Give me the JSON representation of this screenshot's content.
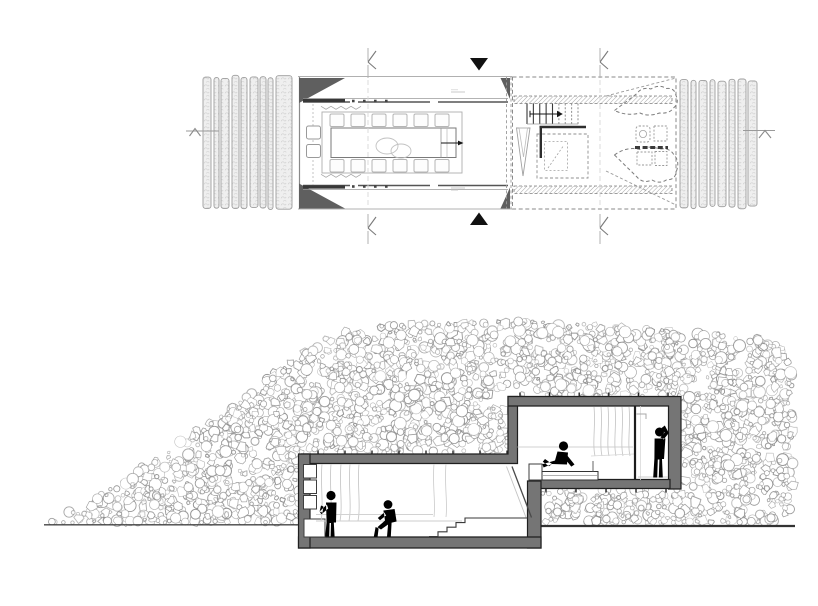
{
  "canvas": {
    "width": 818,
    "height": 606,
    "background": "#ffffff"
  },
  "palette": {
    "wall_fill": "#757575",
    "wall_stroke": "#1f1f1f",
    "triangle_fill": "#5f5f5f",
    "hatch_fill": "#efefef",
    "hatch_stroke": "#9c9c9c",
    "pebble_stroke": "#8d8d8d",
    "figure_fill": "#000000",
    "line_dark": "#2e2e2e",
    "line_mid": "#8a8a8a",
    "line_light": "#c9c9c9"
  },
  "plan": {
    "left_hatch": {
      "y_top": 75,
      "y_bottom": 210,
      "strips": [
        [
          203,
          8
        ],
        [
          214,
          5
        ],
        [
          221,
          8
        ],
        [
          232,
          7
        ],
        [
          241,
          6
        ],
        [
          250,
          8
        ],
        [
          260,
          6
        ],
        [
          268,
          5
        ],
        [
          276,
          16
        ]
      ]
    },
    "right_hatch": {
      "y_top": 78,
      "y_bottom": 209,
      "strips": [
        [
          680,
          8
        ],
        [
          691,
          5
        ],
        [
          699,
          8
        ],
        [
          710,
          5
        ],
        [
          718,
          8
        ],
        [
          729,
          6
        ],
        [
          738,
          8
        ],
        [
          748,
          9
        ]
      ]
    },
    "dining": {
      "chair_xs": [
        330,
        351,
        372,
        393,
        414,
        435
      ],
      "stool_ys": [
        126,
        144.5
      ]
    },
    "stair": {
      "risers": 9,
      "solid_risers": 5
    },
    "k_markers": [
      [
        368,
        48
      ],
      [
        600,
        48
      ],
      [
        368,
        214
      ],
      [
        600,
        214
      ]
    ],
    "flag_down": [
      479,
      58
    ],
    "flag_up": [
      479,
      225
    ],
    "side_marker_left": [
      186,
      131
    ],
    "side_marker_right": [
      743,
      130.5
    ]
  },
  "section": {
    "mound_profile": [
      [
        48,
        524
      ],
      [
        70,
        510
      ],
      [
        95,
        497
      ],
      [
        115,
        486
      ],
      [
        135,
        471
      ],
      [
        155,
        457
      ],
      [
        175,
        445
      ],
      [
        200,
        429
      ],
      [
        225,
        411
      ],
      [
        250,
        394
      ],
      [
        275,
        372
      ],
      [
        295,
        356
      ],
      [
        315,
        344
      ],
      [
        335,
        334
      ],
      [
        355,
        329
      ],
      [
        380,
        326
      ],
      [
        410,
        324
      ],
      [
        440,
        323
      ],
      [
        470,
        322
      ],
      [
        500,
        321
      ],
      [
        530,
        321
      ],
      [
        560,
        322
      ],
      [
        590,
        324
      ],
      [
        620,
        326
      ],
      [
        650,
        329
      ],
      [
        680,
        331
      ],
      [
        710,
        333
      ],
      [
        740,
        335
      ],
      [
        765,
        338
      ],
      [
        780,
        342
      ],
      [
        788,
        355
      ],
      [
        792,
        375
      ],
      [
        794,
        400
      ],
      [
        795,
        440
      ],
      [
        794,
        480
      ],
      [
        793,
        524
      ]
    ],
    "building_envelope": [
      [
        299,
        454
      ],
      [
        509,
        454
      ],
      [
        509,
        397
      ],
      [
        681,
        397
      ],
      [
        681,
        489
      ],
      [
        541,
        489
      ],
      [
        541,
        527
      ],
      [
        299,
        527
      ]
    ],
    "pebbles": {
      "seed": 1337,
      "attempts": 5200,
      "r_min": 1.7,
      "r_max": 6.0
    },
    "ground_left": [
      44,
      301,
      524.8
    ],
    "ground_right": [
      538,
      795,
      526
    ],
    "figures": [
      {
        "pose": "standing",
        "label": "person-standing"
      },
      {
        "pose": "leaning",
        "label": "person-leaning-on-steps"
      },
      {
        "pose": "sitting",
        "label": "person-sitting-on-bed"
      },
      {
        "pose": "showering",
        "label": "person-showering"
      }
    ]
  }
}
